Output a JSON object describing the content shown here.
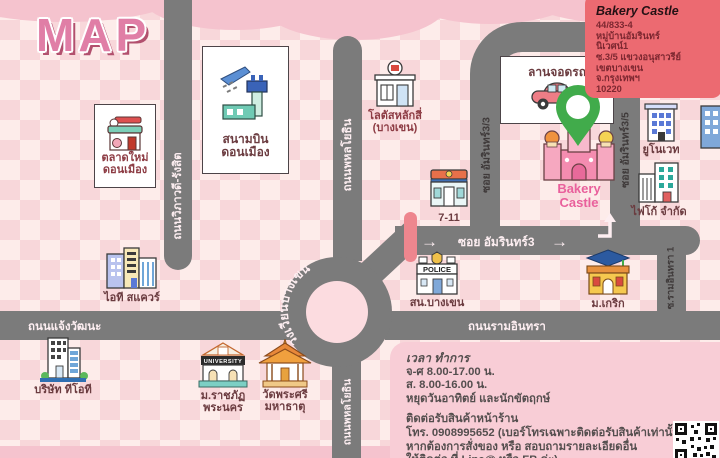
{
  "title": "MAP",
  "colors": {
    "background": "#fdecea",
    "checker": "#f8d7da",
    "cloud": "#f5c3ce",
    "road": "#7b7b7b",
    "info_card_bg": "#ec6a71",
    "hours_panel_bg": "#f8cdd6",
    "pin_green": "#41ab4b",
    "bakery_pink": "#e9609c",
    "crossing_bar": "#ee868e"
  },
  "icons": {
    "arrow_right": "→"
  },
  "info_card": {
    "title": "Bakery Castle",
    "lines": [
      "44/833-4",
      "หมู่บ้านอัมรินทร์",
      "นิเวศน์1",
      "ซ.3/5 แขวงอนุสาวรีย์",
      "เขตบางเขน",
      "จ.กรุงเทพฯ",
      "10220"
    ]
  },
  "roads": {
    "vibhavadi": "ถนนวิภาวดี-รังสิต",
    "phahonyothin_top": "ถนนพหลโยธิน",
    "phahonyothin_bottom": "ถนนพหลโยธิน",
    "soi_amarin_3_3": "ซอย อัมรินทร์3/3",
    "soi_amarin_3_5": "ซอย อัมรินทร์3/5",
    "soi_amarin_3": "ซอย อัมรินทร์3",
    "bangkhen_circle": "วงเวียนบางเขน",
    "chaengwattana": "ถนนแจ้งวัฒนะ",
    "raminthra": "ถนนรามอินทรา",
    "soi_raminthra_1": "ซ.รามอินทรา 1"
  },
  "landmarks": {
    "market": {
      "line1": "ตลาดใหม่",
      "line2": "ดอนเมือง"
    },
    "airport": {
      "line1": "สนามบิน",
      "line2": "ดอนเมือง"
    },
    "lotus": {
      "line1": "โลตัสหลักสี่",
      "line2": "(บางเขน)"
    },
    "seven_eleven": {
      "label": "7-11"
    },
    "parking": {
      "label": "ลานจอดรถ"
    },
    "bakery": {
      "line1": "Bakery",
      "line2": "Castle"
    },
    "unovate": {
      "label": "ยูโนเวท"
    },
    "figo": {
      "label": "ไฟโก้ จำกัด"
    },
    "it_square": {
      "label": "ไอที สแควร์"
    },
    "police": {
      "label": "สน.บางเขน",
      "sign": "POLICE"
    },
    "krirk": {
      "label": "ม.เกริก"
    },
    "tot": {
      "label": "บริษัท ทีโอที"
    },
    "rajabhat": {
      "line1": "ม.ราชภัฏ",
      "line2": "พระนคร",
      "sign": "UNIVERSITY"
    },
    "temple": {
      "line1": "วัดพระศรี",
      "line2": "มหาธาตุ"
    }
  },
  "hours": {
    "heading": "เวลา ทำการ",
    "lines1": [
      "จ-ศ 8.00-17.00 น.",
      "ส. 8.00-16.00 น.",
      "หยุดวันอาทิตย์ และนักขัตฤกษ์"
    ],
    "lines2": [
      "ติดต่อรับสินค้าหน้าร้าน",
      "โทร. 0908995652 (เบอร์โทรเฉพาะติดต่อรับสินค้าเท่านั้น)",
      "หากต้องการสั่งของ หรือ สอบถามรายละเอียดอื่น",
      "ให้ติดต่อ ที่ Line@ หรือ FB ค่ะ)"
    ]
  }
}
